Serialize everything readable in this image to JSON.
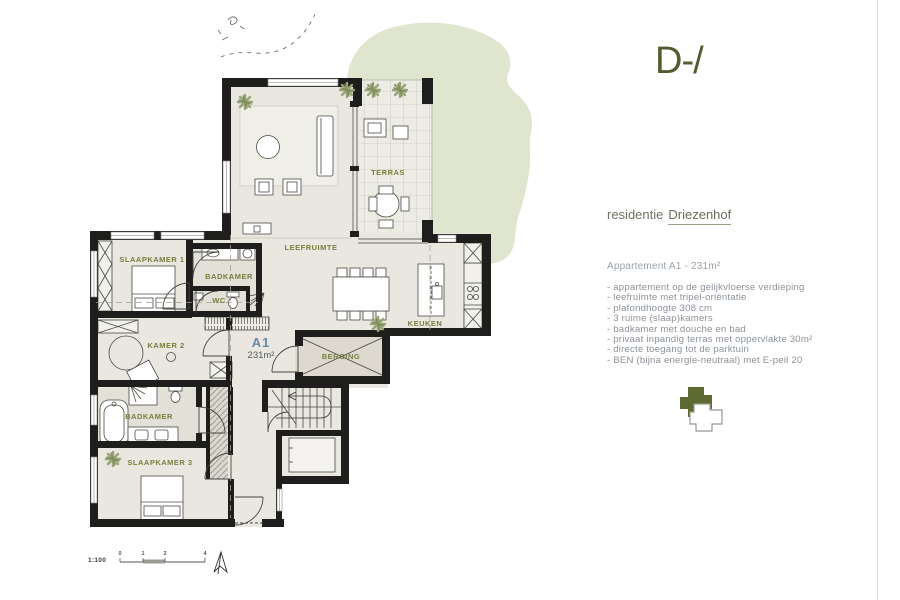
{
  "brand": {
    "logo_text": "D-/",
    "residence_prefix": "residentie",
    "residence_name": "Driezenhof"
  },
  "apartment": {
    "title": "Appartement A1 - 231m²",
    "features": [
      "- appartement op de gelijkvloerse verdieping",
      "- leefruimte met tripel-oriëntatie",
      "- plafondhoogte 308 cm",
      "- 3 ruime (slaap)kamers",
      "- badkamer met douche en bad",
      "- privaat inpandig terras met oppervlakte 30m²",
      "- directe toegang tot de parktuin",
      "- BEN (bijna energie-neutraal) met E-peil 20"
    ]
  },
  "plan": {
    "rooms": {
      "slaapkamer1": "SLAAPKAMER 1",
      "badkamer_top": "BADKAMER",
      "wc": "WC",
      "leefruimte": "LEEFRUIMTE",
      "terras": "TERRAS",
      "keuken": "KEUKEN",
      "kamer2": "KAMER 2",
      "berging": "BERGING",
      "badkamer_bottom": "BADKAMER",
      "slaapkamer3": "SLAAPKAMER 3"
    },
    "unit": {
      "code": "A1",
      "area": "231m²"
    },
    "scale": {
      "label": "1:100",
      "ticks": [
        "0",
        "1",
        "2",
        "4"
      ]
    }
  },
  "colors": {
    "label_olive": "#76803d",
    "unit_blue": "#6b89a6",
    "garden_green": "#dfe5cf",
    "wall_black": "#1e1e1c",
    "floor": "#e9e7e0"
  }
}
